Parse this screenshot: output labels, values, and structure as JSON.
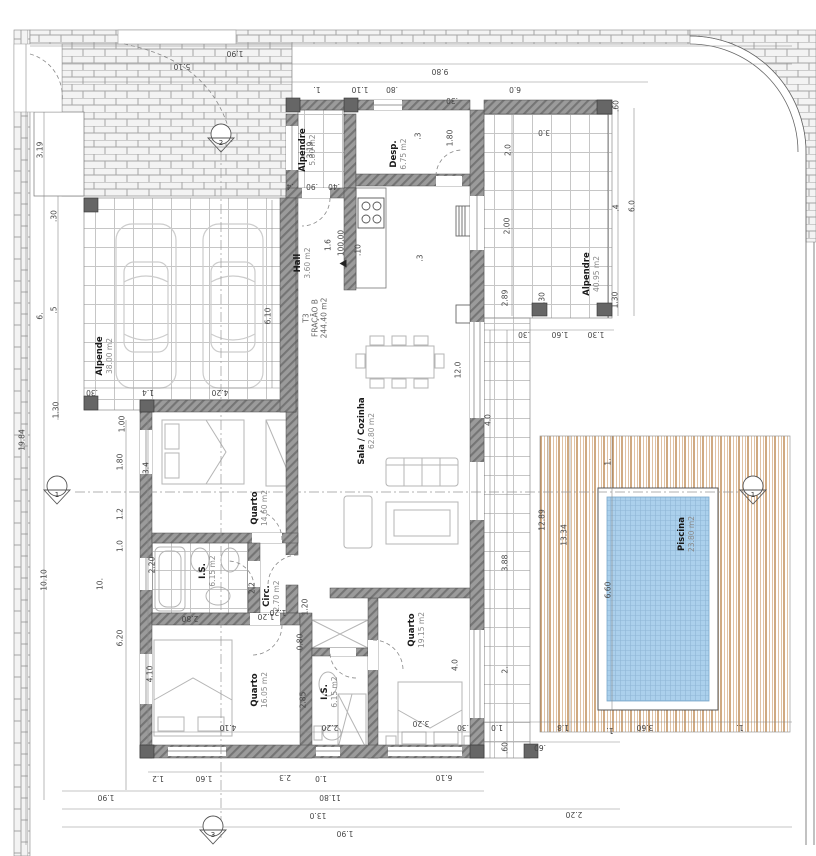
{
  "colors": {
    "pool-water": "#abd0ec",
    "pool-grid": "#8fb6d6",
    "deck-line-dark": "#b0712f",
    "deck-line-light": "#e0c2a4",
    "wall-fill": "#9b9b9b",
    "wall-hatch": "#757575",
    "tile-line": "#c6c6c6",
    "brick-line": "#a6a6a6",
    "dim-text": "#444444",
    "furniture-line": "#b5b5b5",
    "car-line": "#cccccc"
  },
  "plan": {
    "fraction": {
      "type": "T3",
      "name": "FRAÇÃO B",
      "area": "244.40 m2"
    },
    "level": "100.00",
    "markers": {
      "left": "1",
      "right": "1",
      "top": "2",
      "bottom": "3"
    },
    "rooms": [
      {
        "id": "alpendre-entry",
        "label": "Alpendre",
        "area": "5.80 m2"
      },
      {
        "id": "desp",
        "label": "Desp.",
        "area": "6.75 m2"
      },
      {
        "id": "hall",
        "label": "Hall",
        "area": "3.60 m2"
      },
      {
        "id": "sala-cozinha",
        "label": "Sala / Cozinha",
        "area": "62.80 m2"
      },
      {
        "id": "quarto-1",
        "label": "Quarto",
        "area": "14.60 m2"
      },
      {
        "id": "is-1",
        "label": "I.S.",
        "area": "6.15 m2"
      },
      {
        "id": "circ",
        "label": "Circ.",
        "area": "2.70 m2"
      },
      {
        "id": "quarto-2",
        "label": "Quarto",
        "area": "16.05 m2"
      },
      {
        "id": "is-2",
        "label": "I.S.",
        "area": "6.15 m2"
      },
      {
        "id": "quarto-3",
        "label": "Quarto",
        "area": "19.15 m2"
      },
      {
        "id": "alpendre-south",
        "label": "Alpendre",
        "area": "40.95 m2"
      },
      {
        "id": "carport",
        "label": "Alpende",
        "area": "38.00 m2"
      },
      {
        "id": "piscina",
        "label": "Piscina",
        "area": "23.80 m2"
      }
    ],
    "dims": [
      "1.90",
      "9.80",
      "1.",
      "1.10",
      ".80",
      "6.0",
      "5.10",
      "19.84",
      "3.19",
      ".30",
      "6.",
      ".5",
      "1.30",
      "1.00",
      "1.80",
      "1.2",
      "1.0",
      "10.10",
      "10.",
      "6.20",
      "3.4",
      "2.20",
      "4.10",
      "6.10",
      "4.20",
      "1.4",
      ".30",
      "3.19",
      ".4",
      ".90",
      ".40",
      "1.6",
      ".10",
      "1.80",
      ".3",
      ".30",
      "12.0",
      ".3",
      "2.0",
      "2.00",
      "2.89",
      "3.0",
      ".60",
      ".4",
      "6.0",
      "1.30",
      ".30",
      ".30",
      "1.60",
      "1.30",
      "4.0",
      "3.88",
      "2.",
      "1.0",
      ".30",
      ".60",
      "12.89",
      "13.34",
      "1.",
      "6.60",
      "1.8",
      "1.",
      "3.60",
      "1.",
      ".60",
      "2.20",
      "1.2",
      "1.60",
      "2.3",
      "1.0",
      "6.10",
      "1.90",
      "11.80",
      "13.0",
      "1.90",
      "2.80",
      "1.20",
      "1.20",
      "0.80",
      "2.85",
      "4.10",
      "2.20",
      "3.20",
      "4.0",
      "2.2",
      "1.20"
    ]
  }
}
